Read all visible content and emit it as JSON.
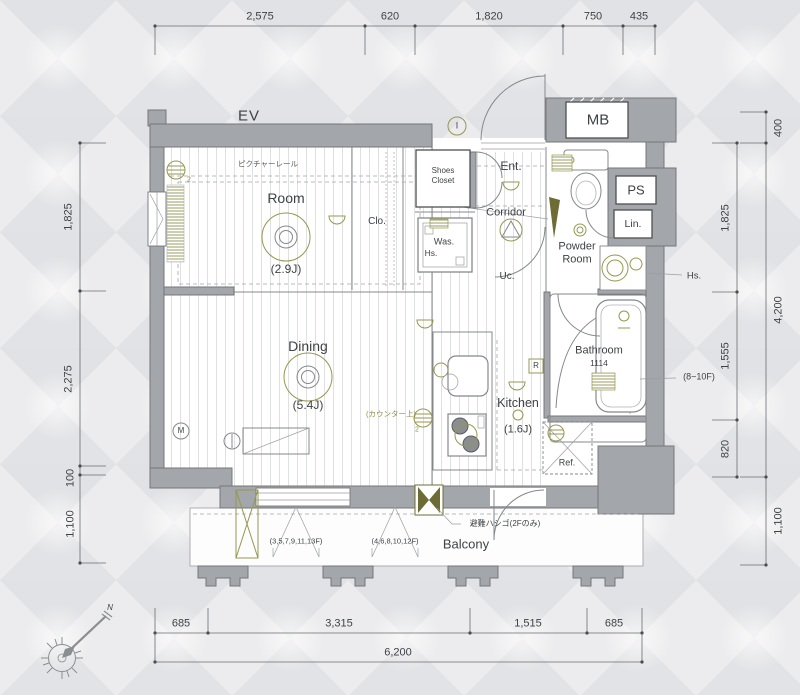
{
  "dims": {
    "top": [
      "2,575",
      "620",
      "1,820",
      "750",
      "435"
    ],
    "left": [
      "1,825",
      "2,275",
      "100",
      "1,100"
    ],
    "right_outer": [
      "400",
      "4,200",
      "1,100"
    ],
    "right_inner": [
      "1,825",
      "1,555",
      "820"
    ],
    "bottom": [
      "685",
      "3,315",
      "1,515",
      "685"
    ],
    "bottom_total": "6,200"
  },
  "rooms": {
    "ev": "EV",
    "mb": "MB",
    "ps": "PS",
    "lin": "Lin.",
    "room_name": "Room",
    "room_size": "(2.9J)",
    "dining_name": "Dining",
    "dining_size": "(5.4J)",
    "kitchen_name": "Kitchen",
    "kitchen_size": "(1.6J)",
    "bathroom_name": "Bathroom",
    "bathroom_size": "1114",
    "powder_line1": "Powder",
    "powder_line2": "Room",
    "corridor": "Corridor",
    "entrance": "Ent.",
    "shoes_line1": "Shoes",
    "shoes_line2": "Closet",
    "closet": "Clo.",
    "utility_closet": "Uc.",
    "washer": "Was.",
    "water_heater": "Hs.",
    "water_heater_right": "Hs.",
    "refrigerator": "Ref.",
    "balcony": "Balcony"
  },
  "notes": {
    "picture_rail": "ピクチャーレール",
    "counter_top": "(カウンター上)",
    "evac_ladder": "避難ハシゴ(2Fのみ)",
    "balcony_floors_odd": "(3,5,7,9,11,13F)",
    "balcony_floors_even": "(4,6,8,10,12F)",
    "bath_floors": "(8~10F)"
  },
  "marks": {
    "r": "R",
    "m": "M",
    "i": "I",
    "north": "N",
    "two_a": "2",
    "two_b": "2"
  },
  "colors": {
    "wall": "#a3a6aa",
    "accent_olive": "#8f8f4b",
    "line": "#85888b",
    "text": "#3f4245"
  }
}
